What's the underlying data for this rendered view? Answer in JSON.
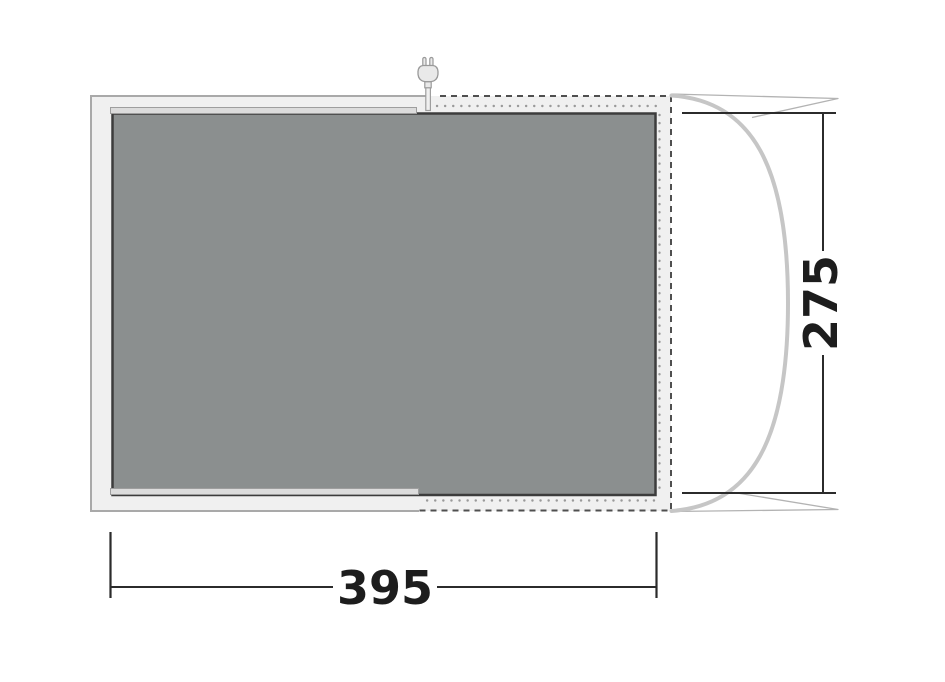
{
  "diagram": {
    "type": "floorplan",
    "dimensions": {
      "width_label": "395",
      "depth_label": "275"
    },
    "icons": [
      {
        "name": "power-plug-icon",
        "meaning": "electric cable entry point at top of tent"
      }
    ],
    "colors": {
      "background": "#ffffff",
      "canvas_fill": "#f0f0f0",
      "canvas_outline": "#a9a9a9",
      "zip_dash_line": "#4f4f4f",
      "vent_dot_line": "#9a9a9a",
      "groundsheet_fill": "#8b8f8f",
      "groundsheet_border": "#3c3c3c",
      "edge_strip_fill": "#dcdcdc",
      "edge_strip_outline": "#9e9e9e",
      "pole_curve": "#c6c6c6",
      "guy_line": "#b3b3b3",
      "dimension_line": "#2b2b2b",
      "dimension_text": "#1d1d1d",
      "plug_fill": "#e9e9e9",
      "plug_outline": "#999999"
    }
  }
}
